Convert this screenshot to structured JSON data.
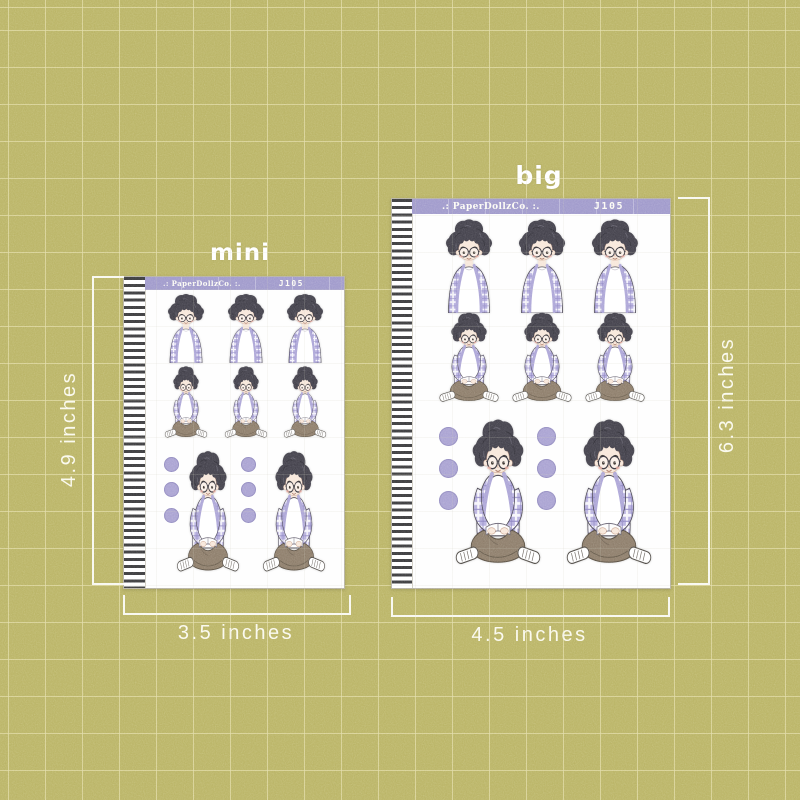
{
  "sheets": [
    {
      "size_label": "mini",
      "brand": ".: PaperDollzCo. :.",
      "code": "J105",
      "width_label": "3.5 inches",
      "height_label": "4.9 inches",
      "sticker_counts": {
        "busts": 3,
        "small_sitting": 3,
        "large_sitting": 2,
        "dots": 6
      }
    },
    {
      "size_label": "big",
      "brand": ".: PaperDollzCo. :.",
      "code": "J105",
      "width_label": "4.5 inches",
      "height_label": "6.3 inches",
      "sticker_counts": {
        "busts": 3,
        "small_sitting": 3,
        "large_sitting": 2,
        "dots": 6
      }
    }
  ],
  "sticker_types": [
    "boy-bust",
    "boy-sitting-reading",
    "purple-dot"
  ],
  "colors": {
    "background": "#b9b364",
    "sheet": "#fefefe",
    "header_bar": "#9e98ca",
    "binding_stripe": "#3a3a3c",
    "dot": "#a8a1d1",
    "plaid_shirt": "#b7b0df",
    "hair": "#42404a",
    "skin": "#f7e7da",
    "pants": "#8c7c69",
    "measure_text": "#fdfcf2",
    "label_text": "#ffffff"
  }
}
